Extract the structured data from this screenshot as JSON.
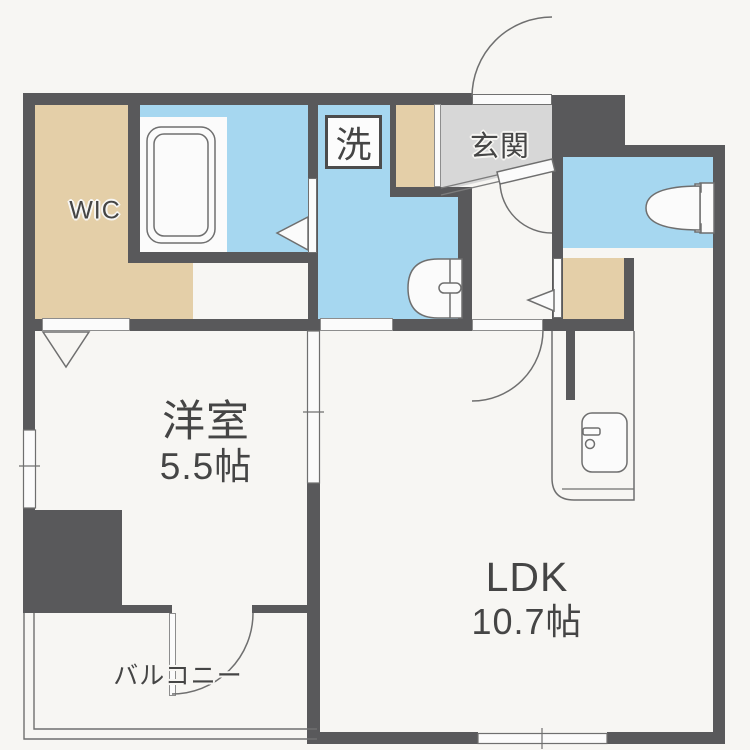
{
  "plan_title": "1LDK apartment floor plan",
  "rooms": {
    "wic": {
      "label": "WIC"
    },
    "laundry": {
      "label": "洗"
    },
    "genkan": {
      "label": "玄関"
    },
    "western_room": {
      "label": "洋室",
      "size": "5.5帖"
    },
    "ldk": {
      "label": "LDK",
      "size": "10.7帖"
    },
    "balcony": {
      "label": "バルコニー"
    }
  },
  "fixtures": [
    "bathtub",
    "toilet",
    "washbasin",
    "kitchen-sink",
    "washing-machine-area"
  ],
  "colors": {
    "wall": "#59595b",
    "water_area": "#a6d7f0",
    "closet_area": "#e4cfa8",
    "entrance_floor": "#d7d7d7",
    "fixture_line": "#6f6f6f",
    "background": "#f7f6f3",
    "text": "#454545"
  }
}
